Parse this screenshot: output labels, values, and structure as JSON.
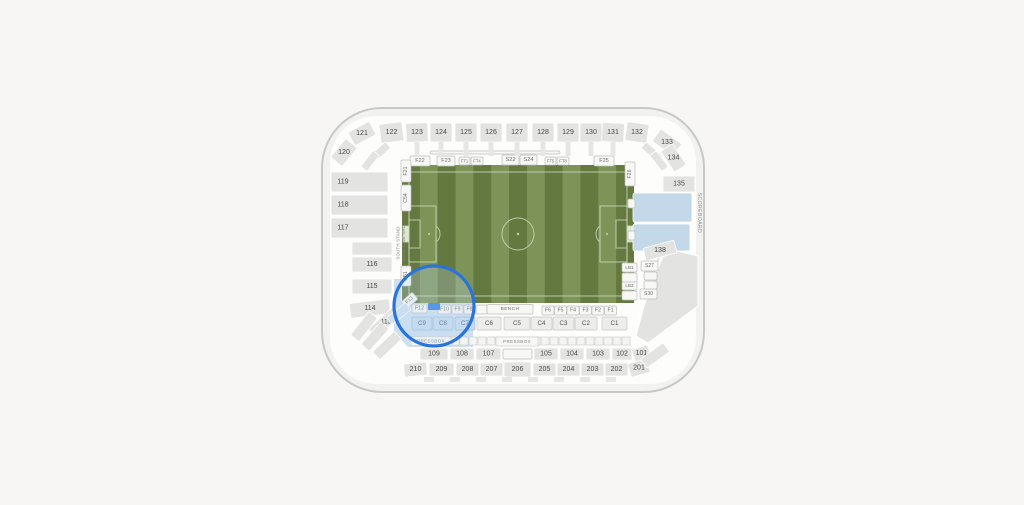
{
  "map": {
    "colors": {
      "background": "#f7f6f4",
      "shell_band": "#f2f2f0",
      "shell_border": "#c8c8c6",
      "inner_bg": "#fdfdfc",
      "section_gray": "#e3e3e1",
      "available_light_blue": "#cfe1f1",
      "club_light_blue": "#c6dbee",
      "scoreboard_blue": "#c3d9ea",
      "selected_blue": "#2e7fe3",
      "highlight_ring_blue": "#2a73da",
      "field_green_dark": "#64793f",
      "field_green_light": "#7d9358",
      "field_line": "#ccd6ba"
    },
    "stands": {
      "top": [
        "122",
        "123",
        "124",
        "125",
        "126",
        "127",
        "128",
        "129",
        "130",
        "131",
        "132"
      ],
      "top_left": [
        "121",
        "120"
      ],
      "left": [
        "119",
        "118",
        "117"
      ],
      "left_lower": [
        "116",
        "115",
        "114"
      ],
      "corner_sw": [
        "113"
      ],
      "right_corner": [
        "133",
        "134",
        "135"
      ],
      "right_mid": [
        "138"
      ],
      "bottom_100": [
        "109",
        "108",
        "107",
        "105",
        "104",
        "103",
        "102",
        "101"
      ],
      "bottom_200": [
        "210",
        "209",
        "208",
        "207",
        "206",
        "205",
        "204",
        "203",
        "202",
        "201"
      ]
    },
    "field_edge": {
      "top": [
        "F22",
        "F23",
        "FT1",
        "FT4",
        "S22",
        "S24",
        "FT5",
        "FT8",
        "F25"
      ],
      "left": [
        "F21",
        "C54",
        "C51",
        "F13"
      ],
      "right": [
        "F26",
        "LB1",
        "LB3"
      ],
      "suites": [
        "S27",
        "S30"
      ],
      "bottom": [
        "F12",
        "F10",
        "F9",
        "F8",
        "F6",
        "F5",
        "F4",
        "F3",
        "F2",
        "F1"
      ]
    },
    "club_row": [
      "C9",
      "C8",
      "C7",
      "C6",
      "C5",
      "C4",
      "C3",
      "C2",
      "C1"
    ],
    "labels": {
      "bench": "BENCH",
      "pressbox_left": "PRESSBOX",
      "pressbox_right": "PRESSBOX",
      "scoreboard": "SCOREBOARD",
      "south_stand_line1": "SOUTH STAND",
      "south_stand_line2": "GOAL-LINE SRO"
    }
  }
}
